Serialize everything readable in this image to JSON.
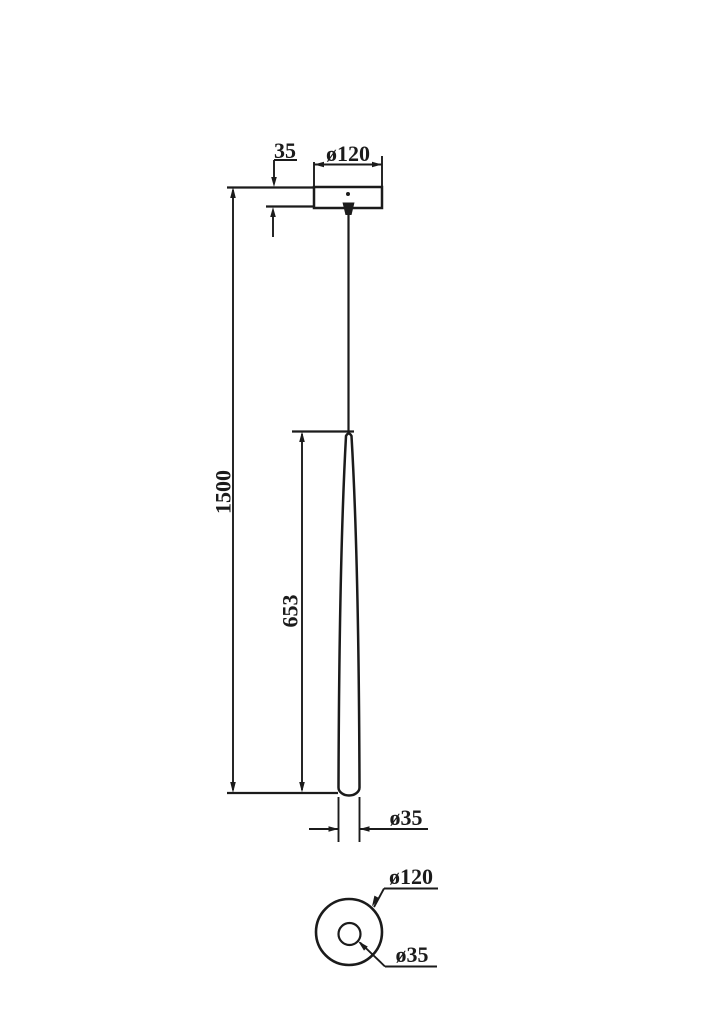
{
  "drawing": {
    "kind": "pendant-lamp-dimension-drawing",
    "colors": {
      "line": "#1b1b1b",
      "background": "#ffffff"
    },
    "side_view": {
      "canopy_height_label": "35",
      "canopy_diameter_label": "ø120",
      "suspension_length_label": "1500",
      "shade_length_label": "653",
      "shade_diameter_label": "ø35"
    },
    "bottom_view": {
      "canopy_diameter_label": "ø120",
      "shade_diameter_label": "ø35"
    }
  }
}
